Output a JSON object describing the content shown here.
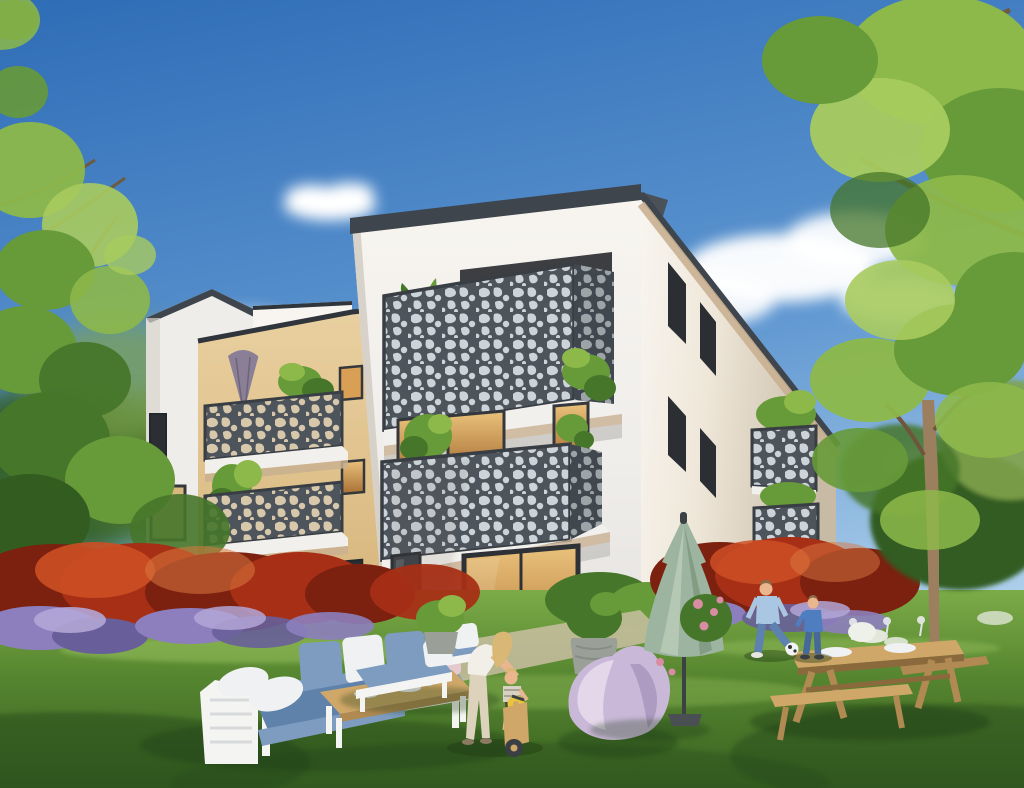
{
  "scene": {
    "type": "architectural-rendering",
    "subject": "modern-apartment-building-with-garden",
    "objects": [
      "blue-sky",
      "clouds",
      "left-tree",
      "right-tree",
      "young-tree",
      "white-apartment-building",
      "gable-wing",
      "beige-wing",
      "perforated-balconies",
      "closed-purple-parasol-on-balcony",
      "red-flower-hedge",
      "purple-flowers",
      "white-flowers",
      "lawn",
      "outdoor-sofa-set",
      "coffee-table",
      "lounge-chairs",
      "planters",
      "woman-helping-toddler-on-balance-bike",
      "lavender-bean-bag",
      "closed-green-parasol",
      "man-and-boy-playing-soccer",
      "soccer-ball",
      "picnic-table-with-tableware",
      "glass-sliding-door"
    ]
  },
  "palette": {
    "sky_top": "#2e6cb6",
    "sky_mid": "#5f97d1",
    "sky_low": "#b9d7ee",
    "cloud": "#ffffff",
    "wall_white": "#efedea",
    "wall_bright": "#f8f5f0",
    "wall_cool": "#e2dfdb",
    "wall_shade": "#d4cfc8",
    "beige_light": "#e9d0a0",
    "beige_mid": "#d9b880",
    "beige_dark": "#bb9257",
    "roof_dark": "#3e454c",
    "coping": "#2f353b",
    "railing_dark": "#4d545c",
    "railing_edge": "#383e44",
    "perf_hole_light": "#ccd4d9",
    "perf_hole_warm": "#d8c8ab",
    "slab_white": "#f2f0ec",
    "fascia_warm": "#c9b091",
    "window_dark": "#2b2f33",
    "window_frame": "#34383c",
    "window_warm": "#d99f55",
    "window_glow": "#eac27c",
    "glass_cool": "#9fb2c2",
    "foliage_bright": "#a8cb5e",
    "foliage_light": "#8db84a",
    "foliage_mid": "#679a38",
    "foliage_dark": "#46762a",
    "foliage_deep": "#325c20",
    "foliage_olive": "#7fa24a",
    "branch": "#6d5b41",
    "trunk_light": "#9b7f5f",
    "trunk_dark": "#6e563c",
    "hedge_red": "#a62f16",
    "hedge_red_light": "#cc4f24",
    "hedge_red_dark": "#7c2010",
    "hedge_orange": "#d97840",
    "flower_purple": "#8d7fbe",
    "flower_purple_light": "#b3a6d6",
    "flower_purple_dark": "#685f9a",
    "flower_white": "#eef0ea",
    "flower_pink": "#d98ca2",
    "lawn_back": "#7cab48",
    "lawn_mid": "#55842f",
    "lawn_front": "#3a6322",
    "lawn_sun": "#9cc561",
    "lawn_shadow": "#27481a",
    "paving": "#cfc2a9",
    "wood_light": "#cfa768",
    "wood_mid": "#b08a52",
    "wood_dark": "#8a6a3c",
    "frame_white": "#f4f4f2",
    "cushion_blue": "#7d9cc0",
    "cushion_blue_deep": "#5f82ab",
    "pillow_white": "#f0f1f3",
    "pillow_pink": "#e6c9ce",
    "beanbag": "#c9b8d8",
    "beanbag_light": "#e3d7e9",
    "beanbag_shade": "#a893bc",
    "parasol_green": "#9db4a0",
    "parasol_green_dark": "#7d977e",
    "parasol_green_light": "#bccdb8",
    "parasol_purple": "#8a7f96",
    "parasol_purple_dark": "#6e6378",
    "pot_grey": "#9aa098",
    "pot_grey_dark": "#767c74",
    "skin": "#e9b68e",
    "hair_blonde": "#d9b775",
    "hair_brown": "#8a6a48",
    "top_white": "#f1efe7",
    "pants_cream": "#ddd3bd",
    "shirt_blue": "#a9c6e2",
    "denim": "#5d82b0",
    "denim_dark": "#47699a",
    "sweater_blue": "#4f7ec0",
    "ball_white": "#f2f4f4",
    "ball_dark": "#2e3338",
    "shadow": "#1d3a12"
  }
}
